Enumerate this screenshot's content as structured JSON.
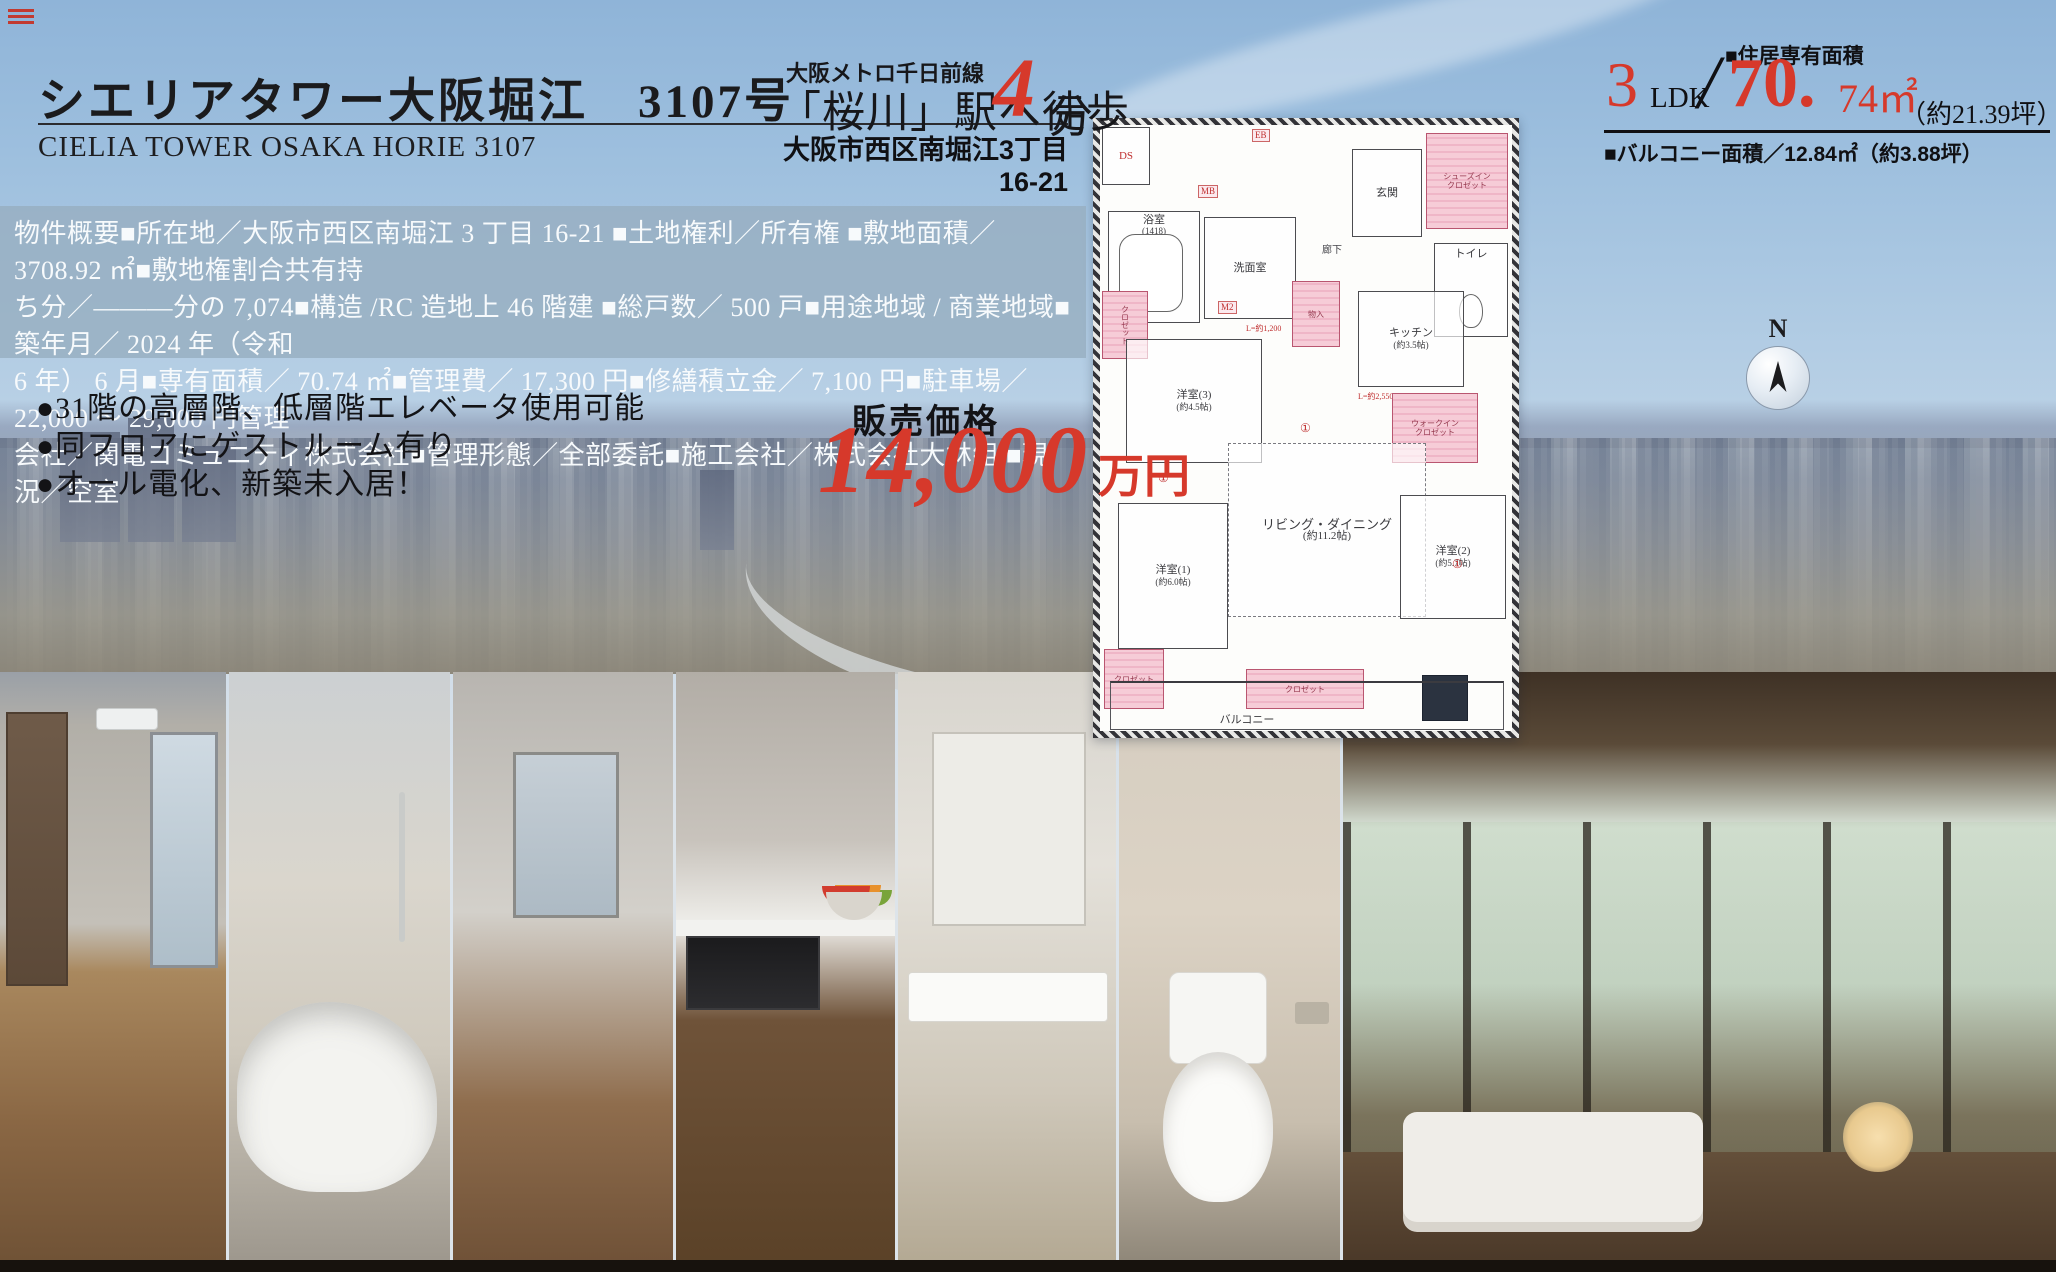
{
  "colors": {
    "accent_red": "#d6392b",
    "band_blue": "rgba(151,174,193,0.82)",
    "plan_pink": "#f4c6d3"
  },
  "header": {
    "title": "シエリアタワー大阪堀江　3107号",
    "subtitle": "CIELIA TOWER OSAKA HORIE 3107"
  },
  "station": {
    "line": "大阪メトロ千日前線",
    "walk_prefix": "「桜川」駅へ徒歩",
    "minutes": "4",
    "walk_suffix": "分",
    "address": "大阪市西区南堀江3丁目16-21"
  },
  "area": {
    "label": "■住居専有面積",
    "ldk_num": "3",
    "ldk_unit": "LDK",
    "slash": "/",
    "size_main": "70.",
    "size_sub": "74㎡",
    "tsubo": "（約21.39坪）",
    "balcony_line": "■バルコニー面積／12.84㎡（約3.88坪）"
  },
  "overview": {
    "line1": "物件概要■所在地／大阪市西区南堀江 3 丁目 16-21 ■土地権利／所有権 ■敷地面積／ 3708.92 ㎡■敷地権割合共有持",
    "line2": "ち分／―――分の 7,074■構造 /RC 造地上 46 階建 ■総戸数／ 500 戸■用途地域 / 商業地域■築年月／ 2024 年（令和",
    "line3": "6 年） 6 月■専有面積／ 70.74 ㎡■管理費／ 17,300 円■修繕積立金／ 7,100 円■駐車場／ 22,000 ～ 29,000 円管理",
    "line4": "会社／関電コミュニティ株式会社■管理形態／全部委託■施工会社／株式会社大林組 ■現況／空室"
  },
  "features": {
    "item1": "●31階の高層階、低層階エレベータ使用可能",
    "item2": "●同フロアにゲストルーム有り",
    "item3": "●オール電化、新築未入居！"
  },
  "price": {
    "label": "販売価格",
    "amount": "14,000",
    "unit": "万円"
  },
  "floorplan": {
    "compass": "N",
    "bath": "浴室",
    "bath_note": "(1418)",
    "wash": "洗面室",
    "entrance": "玄関",
    "sic_1": "シューズイン",
    "sic_2": "クロゼット",
    "toilet": "トイレ",
    "hall": "廊下",
    "kitchen": "キッチン",
    "kitchen_note": "(約3.5帖)",
    "storage": "物入",
    "closet": "クロゼット",
    "closet_b1": "クロゼット",
    "closet_b2": "クロゼット",
    "wic_1": "ウォークイン",
    "wic_2": "クロゼット",
    "bed3": "洋室(3)",
    "bed3_note": "(約4.5帖)",
    "living": "リビング・ダイニング",
    "living_note": "(約11.2帖)",
    "bed1": "洋室(1)",
    "bed1_note": "(約6.0帖)",
    "bed2": "洋室(2)",
    "bed2_note": "(約5.7帖)",
    "balcony": "バルコニー",
    "ds": "DS",
    "mb": "MB",
    "eb": "EB",
    "m2": "M2",
    "dim1": "L=約1,200",
    "dim2": "L=約2,550",
    "mark": "①"
  }
}
